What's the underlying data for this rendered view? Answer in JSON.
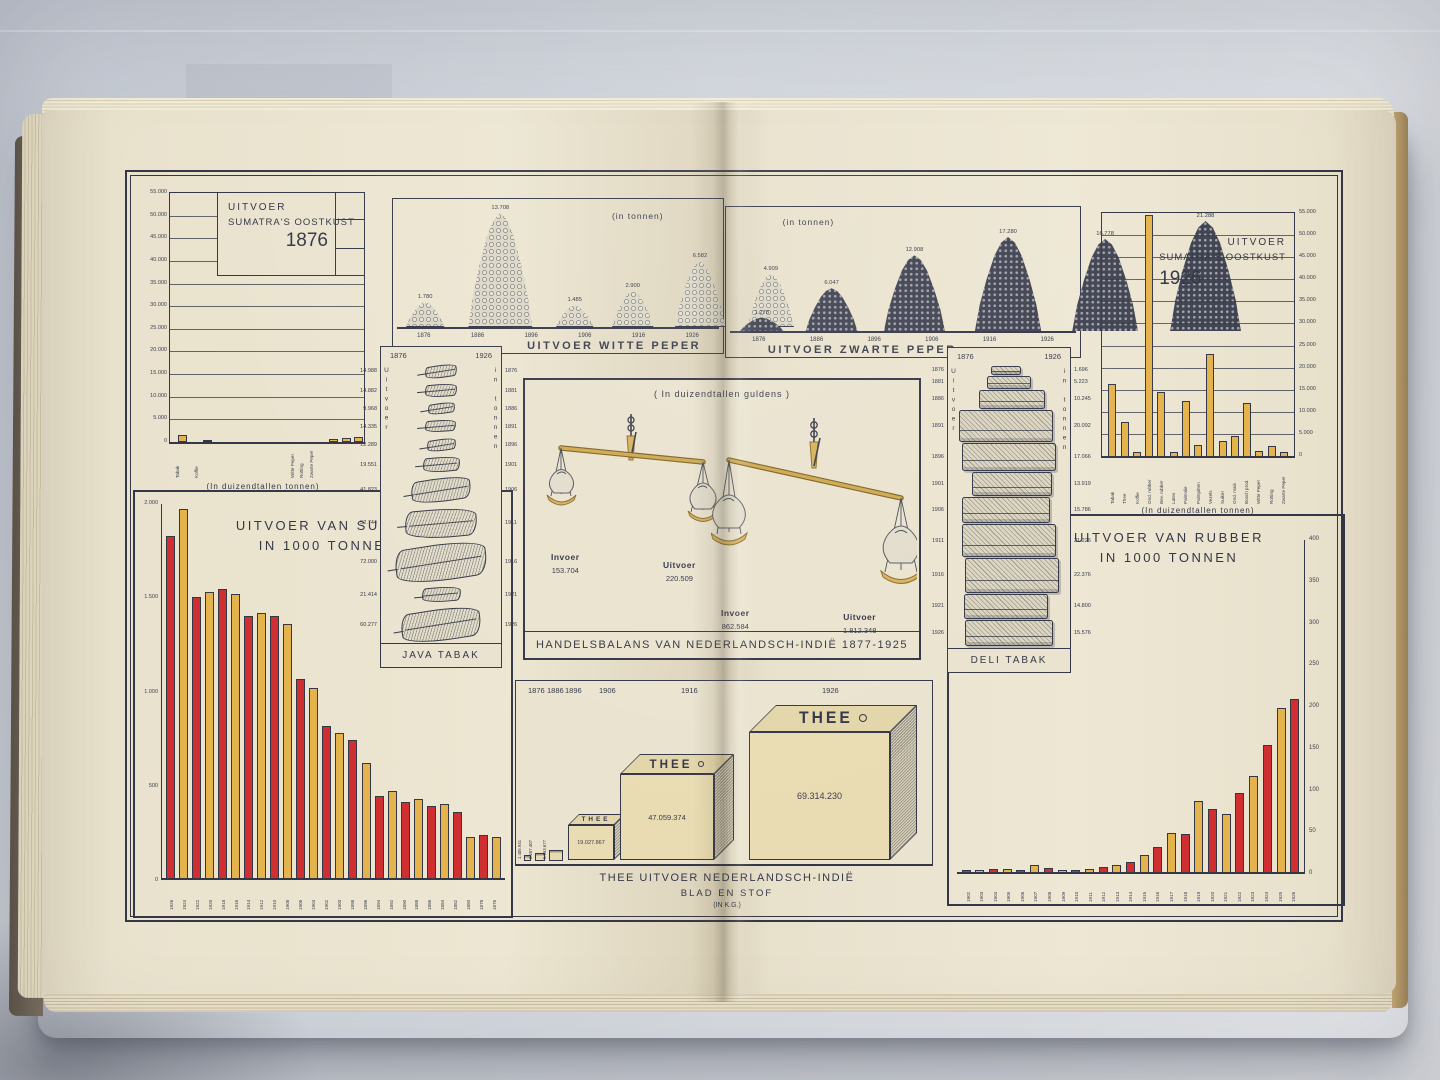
{
  "scene": {
    "background_color": "#cfd4db",
    "page_color": "#eae3cf",
    "ink_color": "#343747",
    "bar_red": "#cf2f30",
    "bar_yellow": "#e5b34c"
  },
  "chart_data": [
    {
      "id": "oostkust-1876",
      "type": "bar",
      "title_lines": [
        "UITVOER",
        "SUMATRA'S OOSTKUST",
        "1876"
      ],
      "caption": "(In duizendtallen tonnen)",
      "ylim": [
        0,
        55000
      ],
      "y_ticks": [
        "55.000",
        "50.000",
        "45.000",
        "40.000",
        "35.000",
        "30.000",
        "25.000",
        "20.000",
        "15.000",
        "10.000",
        "5.000",
        "0"
      ],
      "categories": [
        "Tabak",
        "Koffie",
        "Witte Peper",
        "Rotting",
        "Zwarte Peper"
      ],
      "values": [
        1500,
        300,
        700,
        900,
        1200
      ],
      "x_percent": [
        4,
        17,
        82,
        88.5,
        95
      ],
      "grid": true,
      "legend_position": "none"
    },
    {
      "id": "witte-peper",
      "type": "bar",
      "title": "UITVOER WITTE PEPER",
      "unit": "(in tonnen)",
      "categories": [
        "1876",
        "1886",
        "1896",
        "1906",
        "1916",
        "1926"
      ],
      "values": [
        1780,
        13708,
        1485,
        2900,
        6582,
        4909
      ],
      "value_labels": [
        "1.780",
        "13.708",
        "1.485",
        "2.900",
        "6.582",
        "4.909"
      ],
      "style": "white-pepper-pile"
    },
    {
      "id": "zwarte-peper",
      "type": "bar",
      "title": "UITVOER ZWARTE PEPER",
      "unit": "(in tonnen)",
      "categories": [
        "1876",
        "1886",
        "1896",
        "1906",
        "1916",
        "1926"
      ],
      "values": [
        1278,
        6047,
        12908,
        17280,
        16778,
        21288
      ],
      "value_labels": [
        "1.278",
        "6.047",
        "12.908",
        "17.280",
        "16.778",
        "21.288"
      ],
      "style": "black-pepper-pile"
    },
    {
      "id": "oostkust-1926",
      "type": "bar",
      "title_lines": [
        "UITVOER",
        "SUMATRA'S OOSTKUST",
        "1926"
      ],
      "caption": "(In duizendtallen tonnen)",
      "ylim": [
        0,
        55000
      ],
      "y_ticks": [
        "55.000",
        "50.000",
        "45.000",
        "40.000",
        "35.000",
        "30.000",
        "25.000",
        "20.000",
        "15.000",
        "10.000",
        "5.000",
        "0"
      ],
      "categories": [
        "Tabak",
        "Thee",
        "Koffie",
        "Ond. rubber",
        "Bev. rubber",
        "Latex",
        "Palmolie",
        "Palmpitten",
        "Vezels",
        "Suiker",
        "Ond. mais",
        "Bosch prod.",
        "Witte Peper",
        "Rotting",
        "Zwarte Peper"
      ],
      "values": [
        16200,
        7600,
        800,
        54500,
        14600,
        800,
        12400,
        2400,
        23000,
        3300,
        4600,
        11900,
        1100,
        2200,
        800
      ],
      "grid": true
    },
    {
      "id": "suiker",
      "type": "bar",
      "title_lines": [
        "UITVOER VAN SUIKER",
        "IN 1000 TONNEN"
      ],
      "ylim": [
        0,
        2000
      ],
      "y_ticks": [
        "2.000",
        "1.500",
        "1.000",
        "500",
        "0"
      ],
      "categories": [
        "1926",
        "1924",
        "1922",
        "1920",
        "1918",
        "1916",
        "1914",
        "1912",
        "1910",
        "1908",
        "1906",
        "1904",
        "1902",
        "1900",
        "1898",
        "1896",
        "1894",
        "1892",
        "1890",
        "1888",
        "1886",
        "1884",
        "1882",
        "1880",
        "1878",
        "1876"
      ],
      "values": [
        1815,
        1955,
        1490,
        1515,
        1535,
        1505,
        1390,
        1405,
        1390,
        1345,
        1055,
        1010,
        805,
        770,
        730,
        610,
        435,
        460,
        405,
        420,
        380,
        395,
        350,
        220,
        230,
        220
      ],
      "bar_colors_alternate": [
        "#cf2f30",
        "#e5b34c"
      ]
    },
    {
      "id": "java-tabak",
      "type": "bar",
      "title": "JAVA TABAK",
      "side_left": "Uitvoer",
      "side_right": "in tonnen",
      "header_left": "1876",
      "header_right": "1926",
      "years": [
        "1876",
        "1881",
        "1886",
        "1891",
        "1896",
        "1901",
        "1906",
        "1911",
        "1916",
        "1921",
        "1926"
      ],
      "values": [
        14988,
        14882,
        9968,
        14335,
        12289,
        19551,
        41823,
        52744,
        72000,
        21414,
        60277
      ],
      "value_labels": [
        "14.988",
        "14.882",
        "9.968",
        "14.335",
        "12.289",
        "19.551",
        "41.823",
        "52.744",
        "72.000",
        "21.414",
        "60.277"
      ]
    },
    {
      "id": "handelsbalans",
      "type": "table",
      "title": "HANDELSBALANS VAN NEDERLANDSCH-INDIË 1877-1925",
      "unit": "( In duizendtallen guldens )",
      "scales": [
        {
          "invoer_label": "Invoer",
          "invoer_value": "153.704",
          "uitvoer_label": "Uitvoer",
          "uitvoer_value": "220.509"
        },
        {
          "invoer_label": "Invoer",
          "invoer_value": "862.584",
          "uitvoer_label": "Uitvoer",
          "uitvoer_value": "1.812.348"
        }
      ]
    },
    {
      "id": "deli-tabak",
      "type": "bar",
      "title": "DELI TABAK",
      "side_left": "Uitvoer",
      "side_right": "in tonnen",
      "header_left": "1876",
      "header_right": "1926",
      "years": [
        "1876",
        "1881",
        "1886",
        "1891",
        "1896",
        "1901",
        "1906",
        "1911",
        "1916",
        "1921",
        "1926"
      ],
      "values": [
        1696,
        5223,
        10245,
        20092,
        17066,
        13919,
        15786,
        21226,
        22376,
        14800,
        15576
      ],
      "value_labels": [
        "1.696",
        "5.223",
        "10.245",
        "20.092",
        "17.066",
        "13.919",
        "15.786",
        "21.226",
        "22.376",
        "14.800",
        "15.576"
      ]
    },
    {
      "id": "rubber",
      "type": "bar",
      "title_lines": [
        "UITVOER VAN RUBBER",
        "IN 1000 TONNEN"
      ],
      "ylim": [
        0,
        400
      ],
      "y_ticks": [
        "400",
        "350",
        "300",
        "250",
        "200",
        "150",
        "100",
        "50",
        "0"
      ],
      "categories": [
        "1902",
        "1903",
        "1904",
        "1905",
        "1906",
        "1907",
        "1908",
        "1909",
        "1910",
        "1911",
        "1912",
        "1913",
        "1914",
        "1915",
        "1916",
        "1917",
        "1918",
        "1919",
        "1920",
        "1921",
        "1922",
        "1923",
        "1924",
        "1925",
        "1926"
      ],
      "values": [
        2,
        3,
        4,
        4,
        3,
        9,
        5,
        3,
        3,
        4,
        6,
        8,
        12,
        20,
        30,
        47,
        45,
        85,
        75,
        70,
        95,
        115,
        152,
        197,
        207
      ],
      "bar_colors_alternate": [
        "#cf2f30",
        "#e5b34c"
      ]
    },
    {
      "id": "thee",
      "type": "bar",
      "title_lines": [
        "THEE UITVOER NEDERLANDSCH-INDIË",
        "BLAD EN STOF",
        "(IN K.G.)"
      ],
      "box_label": "THEE",
      "years": [
        "1876",
        "1886",
        "1896",
        "1906",
        "1916",
        "1926"
      ],
      "value_labels": [
        "1.405.941",
        "3.267.407",
        "5.163.677",
        "19.027.867",
        "47.059.374",
        "69.314.230"
      ]
    }
  ]
}
